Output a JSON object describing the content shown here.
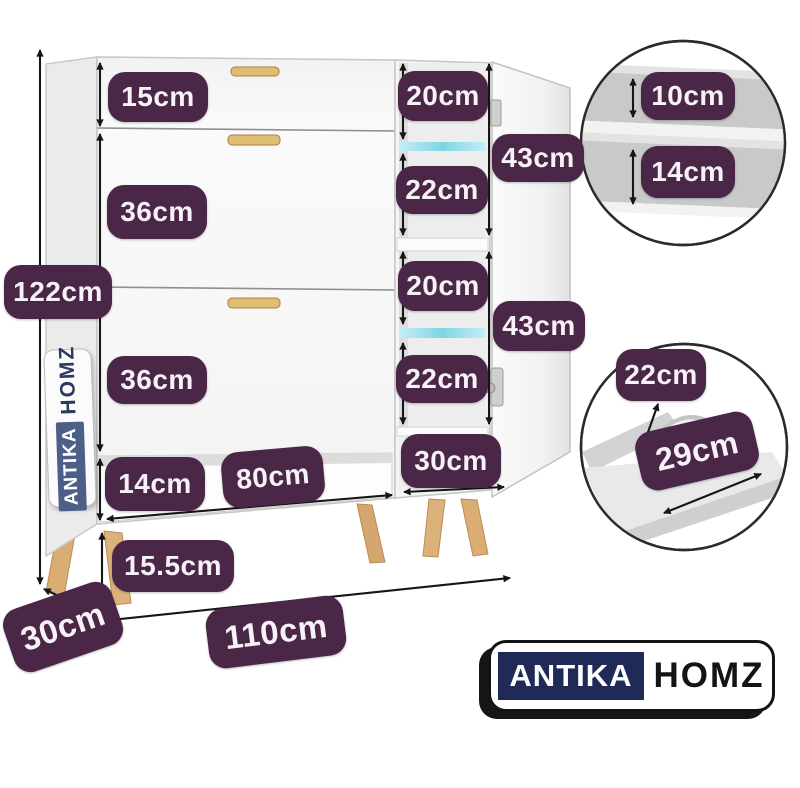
{
  "figure": {
    "kind": "shoe-cabinet dimension diagram",
    "background": "#ffffff"
  },
  "brand": {
    "antika": "ANTIKA",
    "homz": "HOMZ"
  },
  "badges": [
    {
      "id": "top-drawer-height",
      "label": "15cm"
    },
    {
      "id": "drawer2-height",
      "label": "36cm"
    },
    {
      "id": "total-height",
      "label": "122cm"
    },
    {
      "id": "drawer3-height",
      "label": "36cm"
    },
    {
      "id": "open-shelf-height",
      "label": "14cm"
    },
    {
      "id": "open-shelf-width",
      "label": "80cm"
    },
    {
      "id": "leg-height",
      "label": "15.5cm"
    },
    {
      "id": "depth",
      "label": "30cm"
    },
    {
      "id": "total-width",
      "label": "110cm"
    },
    {
      "id": "cubby1-upper-height",
      "label": "20cm"
    },
    {
      "id": "cubby-group1-height",
      "label": "43cm"
    },
    {
      "id": "cubby1-lower-height",
      "label": "22cm"
    },
    {
      "id": "cubby2-upper-height",
      "label": "20cm"
    },
    {
      "id": "cubby-group2-height",
      "label": "43cm"
    },
    {
      "id": "cubby2-lower-height",
      "label": "22cm"
    },
    {
      "id": "side-column-width",
      "label": "30cm"
    },
    {
      "id": "inset-shelf-gap-upper",
      "label": "10cm"
    },
    {
      "id": "inset-shelf-gap-lower",
      "label": "14cm"
    },
    {
      "id": "inset-drawer-height",
      "label": "22cm"
    },
    {
      "id": "inset-drawer-depth",
      "label": "29cm"
    }
  ],
  "colors": {
    "badge_bg": "#4a2747",
    "badge_text": "#f7f2f7",
    "led_strip": "#7fd4e4",
    "wood_legs": "#d9ad74",
    "logo_navy": "#1f2b56",
    "cabinet_white": "#f6f6f6",
    "arrow_black": "#161616"
  }
}
